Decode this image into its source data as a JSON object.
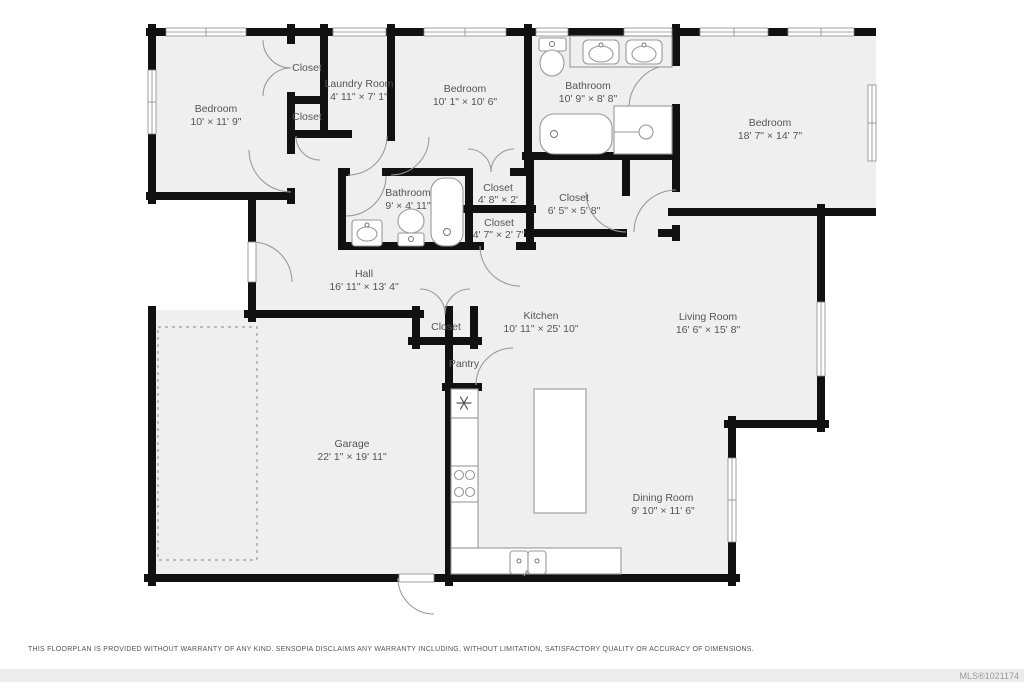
{
  "colors": {
    "wall": "#111111",
    "floor": "#efefef",
    "label_text": "#555555",
    "fixture_line": "#999999",
    "footer_bar": "#ececec"
  },
  "rooms": {
    "bedroom1": {
      "name": "Bedroom",
      "dims": "10' × 11' 9\""
    },
    "closet_top": {
      "name": "Closet"
    },
    "laundry": {
      "name": "Laundry Room",
      "dims": "4' 11\" × 7' 1\""
    },
    "closet_mid": {
      "name": "Closet"
    },
    "bedroom2": {
      "name": "Bedroom",
      "dims": "10' 1\" × 10' 6\""
    },
    "bathroom_main": {
      "name": "Bathroom",
      "dims": "10' 9\" × 8' 8\""
    },
    "bedroom3": {
      "name": "Bedroom",
      "dims": "18' 7\" × 14' 7\""
    },
    "bathroom_hall": {
      "name": "Bathroom",
      "dims": "9' × 4' 11\""
    },
    "closet_48": {
      "name": "Closet",
      "dims": "4' 8\" × 2'"
    },
    "closet_65": {
      "name": "Closet",
      "dims": "6' 5\" × 5' 8\""
    },
    "closet_47": {
      "name": "Closet",
      "dims": "4' 7\" × 2' 7\""
    },
    "hall": {
      "name": "Hall",
      "dims": "16' 11\" × 13' 4\""
    },
    "closet_hall": {
      "name": "Closet"
    },
    "kitchen": {
      "name": "Kitchen",
      "dims": "10' 11\" × 25' 10\""
    },
    "living": {
      "name": "Living Room",
      "dims": "16' 6\" × 15' 8\""
    },
    "pantry": {
      "name": "Pantry"
    },
    "garage": {
      "name": "Garage",
      "dims": "22' 1\" × 19' 11\""
    },
    "dining": {
      "name": "Dining Room",
      "dims": "9' 10\" × 11' 6\""
    }
  },
  "footer": {
    "disclaimer": "THIS FLOORPLAN IS PROVIDED WITHOUT WARRANTY OF ANY KIND. SENSOPIA DISCLAIMS ANY WARRANTY INCLUDING, WITHOUT LIMITATION, SATISFACTORY QUALITY OR ACCURACY OF DIMENSIONS.",
    "mls": "MLS®1021174"
  }
}
